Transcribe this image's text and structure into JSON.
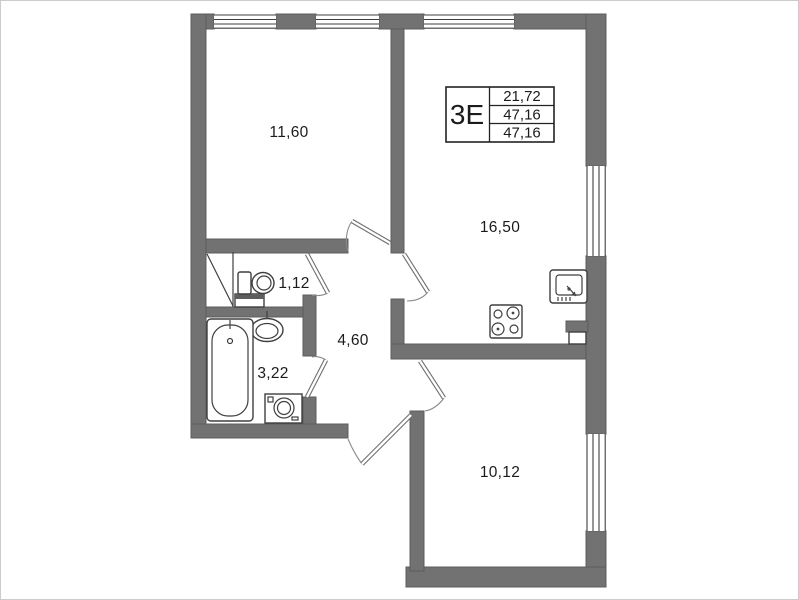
{
  "plan": {
    "legend": {
      "type": "3Е",
      "values": [
        "21,72",
        "47,16",
        "47,16"
      ]
    },
    "rooms": [
      {
        "key": "living-room",
        "area": "11,60"
      },
      {
        "key": "kitchen-living",
        "area": "16,50"
      },
      {
        "key": "wc",
        "area": "1,12"
      },
      {
        "key": "bathroom",
        "area": "3,22"
      },
      {
        "key": "hallway",
        "area": "4,60"
      },
      {
        "key": "bedroom",
        "area": "10,12"
      }
    ],
    "fixtures": [
      "toilet",
      "washbasin",
      "bathtub",
      "washing-machine",
      "stove",
      "kitchen-sink"
    ],
    "colors": {
      "wall": "#727272",
      "wall_outline": "#5c5c5c",
      "line": "#3f3f3f",
      "door": "#8a8a8a",
      "text": "#1b1b1b",
      "background": "#ffffff",
      "border": "#cccccc"
    }
  }
}
